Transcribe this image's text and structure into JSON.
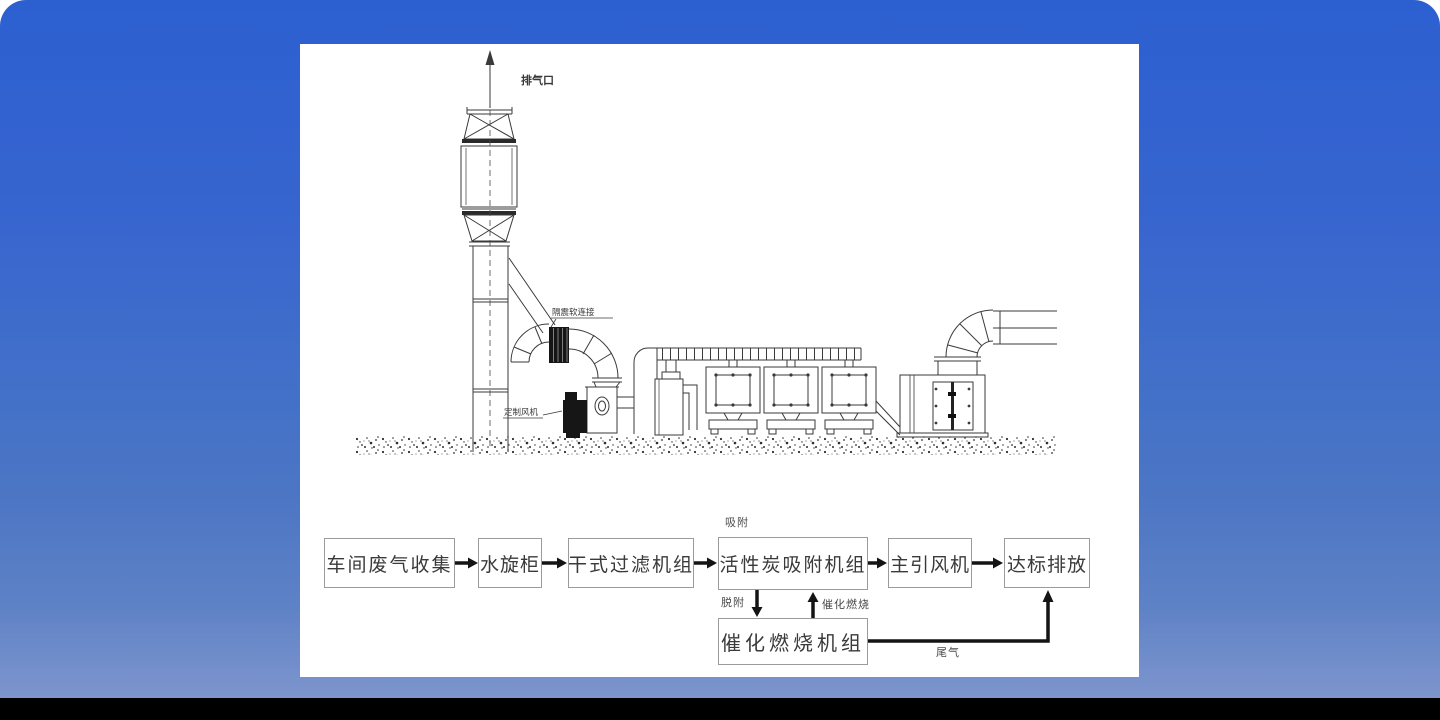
{
  "scene": {
    "background_top_color": "#2c5fd0",
    "background_bottom_color": "#7e95cd",
    "letterbox_color": "#000000",
    "panel_color": "#ffffff"
  },
  "drawing": {
    "labels": {
      "exhaust_outlet": "排气口",
      "flexible_connector": "隔震软连接",
      "custom_fan": "定制风机"
    }
  },
  "flowchart": {
    "boxes": [
      {
        "id": "workshop-waste-gas-collection",
        "label": "车间废气收集"
      },
      {
        "id": "water-spray-cabinet",
        "label": "水旋柜"
      },
      {
        "id": "dry-filter-unit",
        "label": "干式过滤机组"
      },
      {
        "id": "activated-carbon-adsorption-unit",
        "label": "活性炭吸附机组"
      },
      {
        "id": "main-induced-draft-fan",
        "label": "主引风机"
      },
      {
        "id": "compliant-discharge",
        "label": "达标排放"
      },
      {
        "id": "catalytic-combustion-unit",
        "label": "催化燃烧机组"
      }
    ],
    "annotations": {
      "adsorption": "吸附",
      "desorption": "脱附",
      "catalytic_combustion": "催化燃烧",
      "tail_gas": "尾气"
    }
  }
}
